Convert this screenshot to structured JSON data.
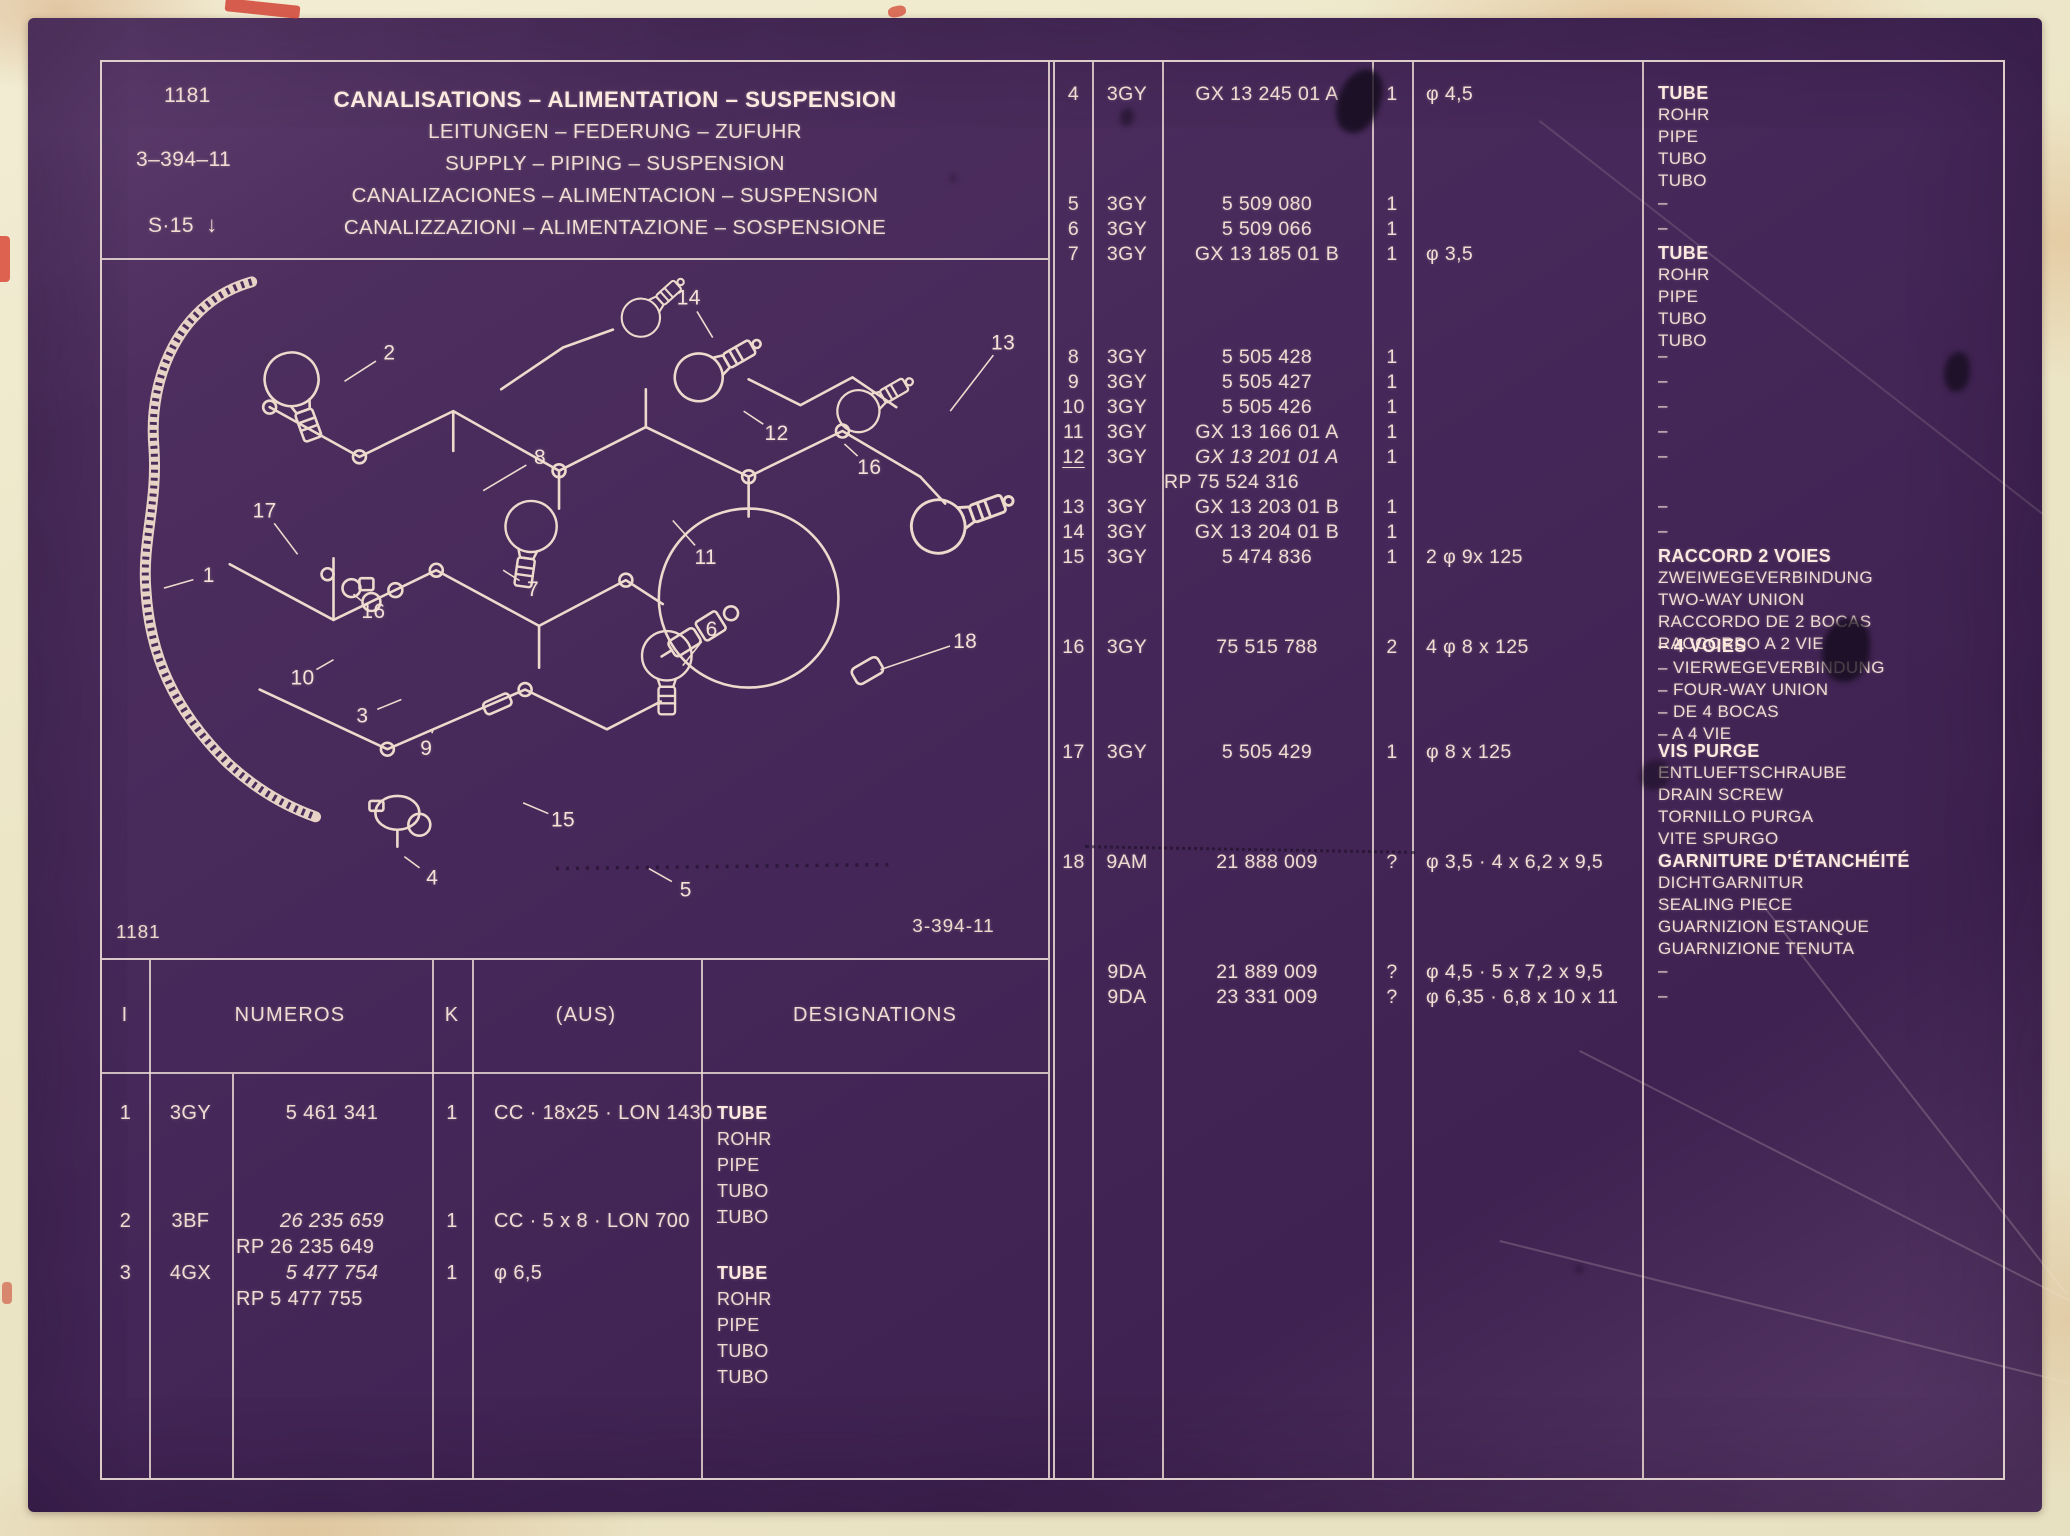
{
  "header": {
    "catalog_number": "1181",
    "plate_ref": "3–394–11",
    "series_label": "S·15",
    "series_arrow": "↓",
    "titles": [
      "CANALISATIONS – ALIMENTATION – SUSPENSION",
      "LEITUNGEN – FEDERUNG – ZUFUHR",
      "SUPPLY – PIPING – SUSPENSION",
      "CANALIZACIONES – ALIMENTACION – SUSPENSION",
      "CANALIZZAZIONI – ALIMENTAZIONE – SOSPENSIONE"
    ]
  },
  "diagram": {
    "corner_left": "1181",
    "corner_right": "3-394-11",
    "callouts": [
      {
        "n": "14",
        "x": 588,
        "y": 45,
        "tx": 612,
        "ty": 78
      },
      {
        "n": "2",
        "x": 288,
        "y": 100,
        "tx": 243,
        "ty": 122
      },
      {
        "n": "13",
        "x": 903,
        "y": 90,
        "tx": 850,
        "ty": 152
      },
      {
        "n": "8",
        "x": 439,
        "y": 205,
        "tx": 382,
        "ty": 232
      },
      {
        "n": "12",
        "x": 676,
        "y": 181,
        "tx": 643,
        "ty": 152
      },
      {
        "n": "16",
        "x": 769,
        "y": 215,
        "tx": 744,
        "ty": 185
      },
      {
        "n": "17",
        "x": 163,
        "y": 259,
        "tx": 196,
        "ty": 296
      },
      {
        "n": "1",
        "x": 107,
        "y": 324,
        "tx": 62,
        "ty": 330
      },
      {
        "n": "7",
        "x": 432,
        "y": 338,
        "tx": 402,
        "ty": 312
      },
      {
        "n": "11",
        "x": 605,
        "y": 306,
        "tx": 572,
        "ty": 262
      },
      {
        "n": "16",
        "x": 272,
        "y": 360,
        "tx": 252,
        "ty": 336
      },
      {
        "n": "10",
        "x": 201,
        "y": 427,
        "tx": 232,
        "ty": 402
      },
      {
        "n": "6",
        "x": 611,
        "y": 378,
        "tx": 582,
        "ty": 408
      },
      {
        "n": "18",
        "x": 865,
        "y": 390,
        "tx": 780,
        "ty": 412
      },
      {
        "n": "3",
        "x": 261,
        "y": 465,
        "tx": 300,
        "ty": 442
      },
      {
        "n": "9",
        "x": 325,
        "y": 498,
        "tx": 332,
        "ty": 472
      },
      {
        "n": "15",
        "x": 462,
        "y": 570,
        "tx": 422,
        "ty": 546
      },
      {
        "n": "4",
        "x": 331,
        "y": 628,
        "tx": 303,
        "ty": 600
      },
      {
        "n": "5",
        "x": 585,
        "y": 640,
        "tx": 548,
        "ty": 612
      }
    ]
  },
  "right_table": {
    "rows": [
      {
        "item": "4",
        "code": "3GY",
        "number": "GX 13 245 01 A",
        "qty": "1",
        "dim": "φ 4,5",
        "desig": [
          "TUBE",
          "ROHR",
          "PIPE",
          "TUBO",
          "TUBO"
        ],
        "bold_first": true
      },
      {
        "item": "5",
        "code": "3GY",
        "number": "5 509 080",
        "qty": "1",
        "dim": "",
        "desig": [
          "–"
        ]
      },
      {
        "item": "6",
        "code": "3GY",
        "number": "5 509 066",
        "qty": "1",
        "dim": "",
        "desig": [
          "–"
        ]
      },
      {
        "item": "7",
        "code": "3GY",
        "number": "GX 13 185 01 B",
        "qty": "1",
        "dim": "φ 3,5",
        "desig": [
          "TUBE",
          "ROHR",
          "PIPE",
          "TUBO",
          "TUBO"
        ],
        "bold_first": true
      },
      {
        "item": "8",
        "code": "3GY",
        "number": "5 505 428",
        "qty": "1",
        "dim": "",
        "desig": [
          "–"
        ]
      },
      {
        "item": "9",
        "code": "3GY",
        "number": "5 505 427",
        "qty": "1",
        "dim": "",
        "desig": [
          "–"
        ]
      },
      {
        "item": "10",
        "code": "3GY",
        "number": "5 505 426",
        "qty": "1",
        "dim": "",
        "desig": [
          "–"
        ]
      },
      {
        "item": "11",
        "code": "3GY",
        "number": "GX 13 166 01 A",
        "qty": "1",
        "dim": "",
        "desig": [
          "–"
        ]
      },
      {
        "item": "12",
        "code": "3GY",
        "number": "GX 13 201 01 A",
        "number_italic": true,
        "number2": "RP 75 524 316",
        "qty": "1",
        "dim": "",
        "desig": [
          "–"
        ],
        "item_underline": true
      },
      {
        "item": "13",
        "code": "3GY",
        "number": "GX 13 203 01 B",
        "qty": "1",
        "dim": "",
        "desig": [
          "–"
        ]
      },
      {
        "item": "14",
        "code": "3GY",
        "number": "GX 13 204 01 B",
        "qty": "1",
        "dim": "",
        "desig": [
          "–"
        ]
      },
      {
        "item": "15",
        "code": "3GY",
        "number": "5 474 836",
        "qty": "1",
        "dim": "2 φ 9x 125",
        "desig": [
          "RACCORD 2 VOIES",
          "ZWEIWEGEVERBINDUNG",
          "TWO-WAY UNION",
          "RACCORDO DE 2 BOCAS",
          "RACCORDO A 2 VIE"
        ],
        "bold_first": true
      },
      {
        "item": "16",
        "code": "3GY",
        "number": "75 515 788",
        "qty": "2",
        "dim": "4 φ 8 x 125",
        "desig": [
          "– 4 VOIES",
          "– VIERWEGEVERBINDUNG",
          "– FOUR-WAY UNION",
          "– DE 4 BOCAS",
          "– A 4 VIE"
        ],
        "bold_first": true
      },
      {
        "item": "17",
        "code": "3GY",
        "number": "5 505 429",
        "qty": "1",
        "dim": "φ 8 x 125",
        "desig": [
          "VIS PURGE",
          "ENTLUEFTSCHRAUBE",
          "DRAIN SCREW",
          "TORNILLO PURGA",
          "VITE SPURGO"
        ],
        "bold_first": true
      },
      {
        "item": "18",
        "code": "9AM",
        "number": "21 888 009",
        "qty": "?",
        "dim": "φ 3,5 · 4 x 6,2 x 9,5",
        "desig": [
          "GARNITURE D'ÉTANCHÉITÉ",
          "DICHTGARNITUR",
          "SEALING PIECE",
          "GUARNIZION ESTANQUE",
          "GUARNIZIONE TENUTA"
        ],
        "bold_first": true
      },
      {
        "item": "",
        "code": "9DA",
        "number": "21 889 009",
        "qty": "?",
        "dim": "φ 4,5 · 5 x 7,2 x 9,5",
        "desig": [
          "–"
        ]
      },
      {
        "item": "",
        "code": "9DA",
        "number": "23 331 009",
        "qty": "?",
        "dim": "φ 6,35 · 6,8 x 10 x 11",
        "desig": [
          "–"
        ]
      }
    ]
  },
  "bottom_table": {
    "headers": {
      "i": "I",
      "numeros": "NUMEROS",
      "k": "K",
      "aus": "(AUS)",
      "designations": "DESIGNATIONS"
    },
    "rows": [
      {
        "item": "1",
        "code": "3GY",
        "numbers": [
          {
            "t": "5 461 341"
          }
        ],
        "qty": "1",
        "aus": "CC · 18x25 · LON 1430",
        "desig": [
          "TUBE",
          "ROHR",
          "PIPE",
          "TUBO",
          "TUBO"
        ],
        "bold_first": true
      },
      {
        "item": "2",
        "code": "3BF",
        "numbers": [
          {
            "t": "26 235 659",
            "i": true
          },
          {
            "t": "RP 26 235 649"
          }
        ],
        "qty": "1",
        "aus": "CC · 5 x 8 · LON 700",
        "desig": [
          "–"
        ]
      },
      {
        "item": "3",
        "code": "4GX",
        "numbers": [
          {
            "t": "5 477 754",
            "i": true
          },
          {
            "t": "RP 5 477 755"
          }
        ],
        "qty": "1",
        "aus": "φ 6,5",
        "desig": [
          "TUBE",
          "ROHR",
          "PIPE",
          "TUBO",
          "TUBO"
        ],
        "bold_first": true
      }
    ]
  }
}
